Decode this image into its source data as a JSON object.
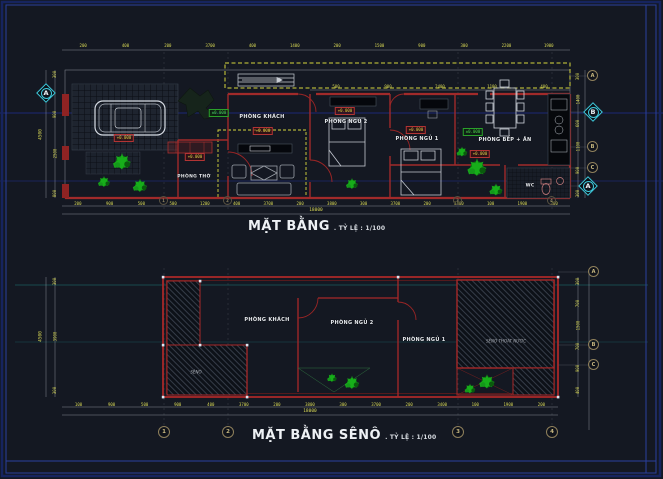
{
  "colors": {
    "wall_red": "#a82828",
    "dim_yellow": "#d8d855",
    "section_cyan": "#3ec9dc",
    "tree_green": "#18b41c",
    "frame_blue": "#2a3f9e"
  },
  "plan_top": {
    "title": "MẶT BẰNG",
    "scale": ". TỶ LỆ : 1/100",
    "rooms": {
      "living": "PHÒNG KHÁCH",
      "bed2": "PHÒNG NGỦ 2",
      "bed1": "PHÒNG NGỦ 1",
      "kitchen": "PHÒNG BẾP + ĂN",
      "worship": "PHÒNG THỜ",
      "wc": "WC"
    },
    "elev": "+0.000",
    "elev_zero": "±0.000",
    "dims_top": [
      "200",
      "400",
      "200",
      "3700",
      "400",
      "1400",
      "200",
      "1500",
      "900",
      "300",
      "2200",
      "1900"
    ],
    "dims_mid": [
      "500",
      "900",
      "2400",
      "1100",
      "400"
    ],
    "dims_bottom": [
      "200",
      "900",
      "500",
      "500",
      "1200",
      "400",
      "3700",
      "200",
      "3800",
      "300",
      "3700",
      "200",
      "3400",
      "100",
      "1900",
      "200"
    ],
    "dim_total": "18000",
    "dims_left": [
      "300",
      "900",
      "2500",
      "800"
    ],
    "dim_left_total": "4500",
    "dims_right": [
      "300",
      "1400",
      "600",
      "1100",
      "900",
      "300"
    ]
  },
  "plan_bottom": {
    "title": "MẶT BẰNG SÊNÔ",
    "scale": ". TỶ LỆ : 1/100",
    "rooms": {
      "living": "PHÒNG KHÁCH",
      "bed2": "PHÒNG NGỦ 2",
      "bed1": "PHÒNG NGỦ 1"
    },
    "notes": {
      "left_gutter": "SÊNÔ",
      "right_gutter": "SÊNÔ THOÁT NƯỚC"
    },
    "dims_bottom": [
      "100",
      "900",
      "500",
      "900",
      "400",
      "3700",
      "200",
      "3800",
      "300",
      "3700",
      "200",
      "3400",
      "100",
      "1900",
      "200"
    ],
    "dim_total": "18000",
    "dims_left": [
      "300",
      "3900",
      "300"
    ],
    "dim_left_total": "4500",
    "dims_right": [
      "300",
      "700",
      "1500",
      "700",
      "900",
      "400"
    ]
  },
  "axes": {
    "section_left": "A",
    "right": {
      "a_top": "A",
      "b_diamond": "B",
      "b": "B",
      "c": "C",
      "a_diamond": "A"
    },
    "bottom": [
      "1",
      "2",
      "3",
      "4"
    ],
    "bottom_right": [
      "A",
      "B",
      "C"
    ]
  }
}
